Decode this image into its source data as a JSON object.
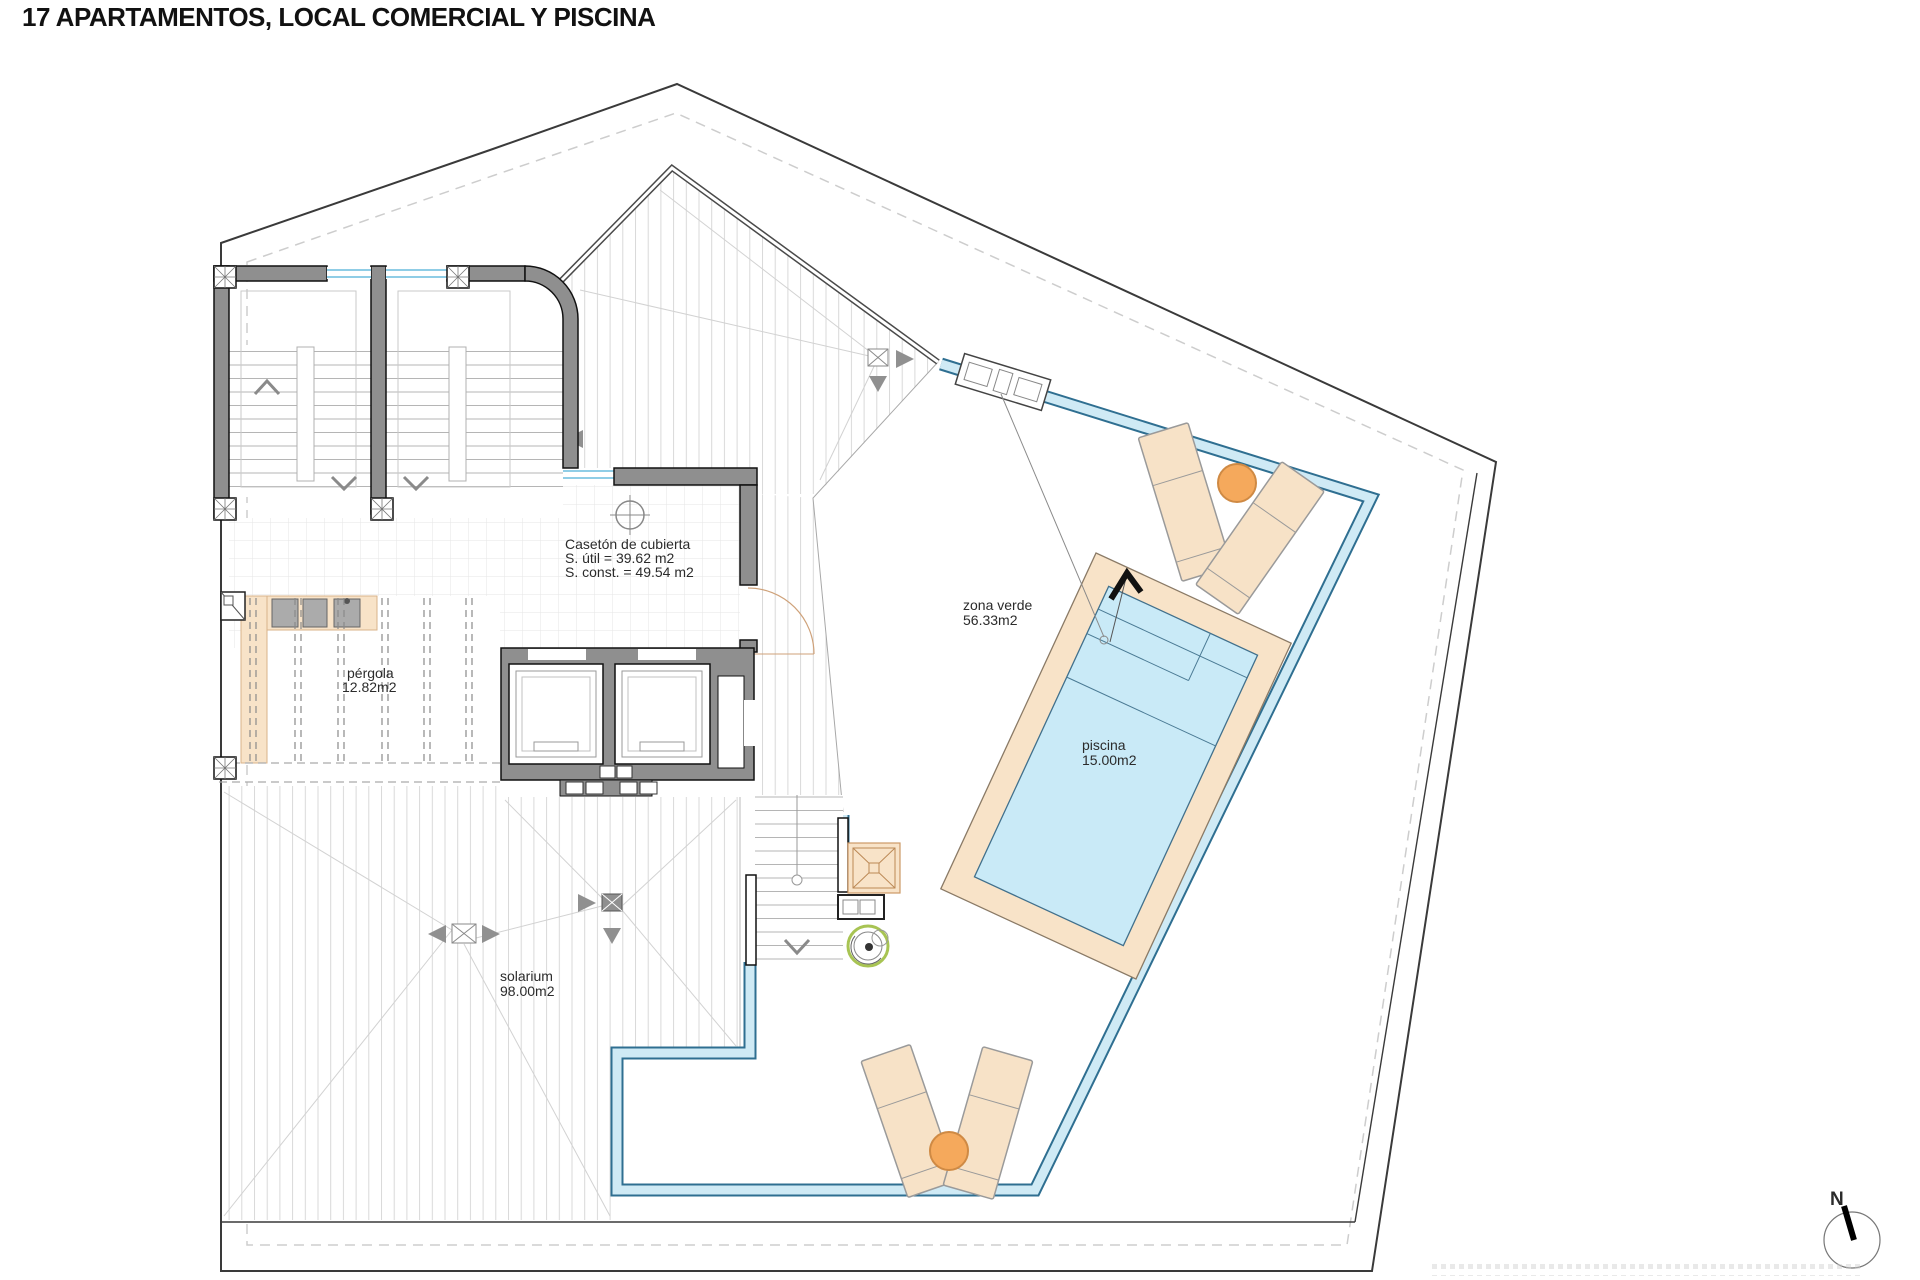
{
  "title": "17 APARTAMENTOS, LOCAL COMERCIAL Y PISCINA",
  "areas": {
    "caseton": {
      "title": "Casetón de cubierta",
      "util": "S. útil = 39.62 m2",
      "const": "S. const. = 49.54 m2"
    },
    "pergola": {
      "name": "pérgola",
      "area": "12.82m2"
    },
    "zona_verde": {
      "name": "zona verde",
      "area": "56.33m2"
    },
    "piscina": {
      "name": "piscina",
      "area": "15.00m2"
    },
    "solarium": {
      "name": "solarium",
      "area": "98.00m2"
    }
  },
  "compass": {
    "label": "N"
  },
  "colors": {
    "wall_gray": "#8f8f8f",
    "pool_water": "#c9eaf7",
    "deck_tan": "#f8e3c8",
    "balustrade_blue": "#2f6f91",
    "balustrade_fill": "#cfeaf5",
    "lounger_tan": "#f7e2c7",
    "accent_orange": "#f5a95c",
    "plant_green": "#a8c453",
    "window_blue": "#8fcde6"
  }
}
